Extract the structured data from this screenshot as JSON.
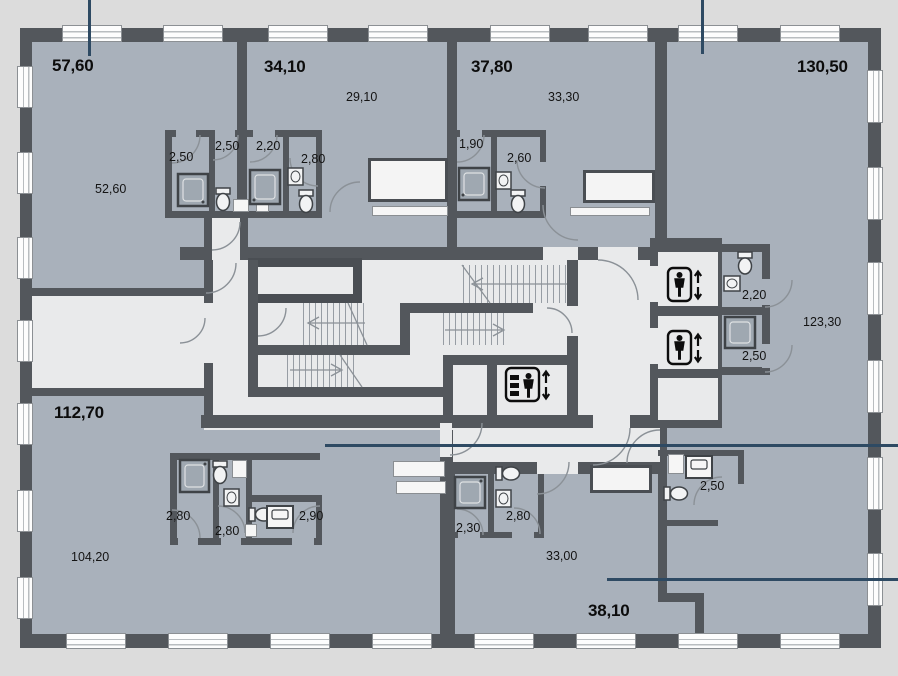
{
  "plan": {
    "apt1": {
      "total": "57,60",
      "living": "52,60",
      "bath_a": "2,50",
      "bath_b": "2,50"
    },
    "apt2": {
      "total": "34,10",
      "living": "29,10",
      "bath_a": "2,20",
      "bath_b": "2,80"
    },
    "apt3": {
      "total": "37,80",
      "living": "33,30",
      "bath_a": "1,90",
      "bath_b": "2,60"
    },
    "apt4": {
      "total": "130,50",
      "living": "123,30",
      "bath_a": "2,20",
      "bath_b": "2,50",
      "bath_c": "2,50"
    },
    "apt5": {
      "total": "112,70",
      "living": "104,20",
      "bath_a": "2,80",
      "bath_b": "2,80",
      "bath_c": "2,90"
    },
    "apt6": {
      "total": "38,10",
      "living": "33,00",
      "bath_a": "2,30",
      "bath_b": "2,80"
    }
  },
  "icons": {
    "passenger_elevator": "passenger-elevator-icon",
    "freight_elevator": "freight-elevator-icon"
  },
  "colors": {
    "outside": "#dcdcdc",
    "wall": "#53575c",
    "apartment_fill": "#a9b1bb",
    "core_fill": "#e9eaeb",
    "leader_line": "#2e4a63",
    "text": "#111111"
  }
}
